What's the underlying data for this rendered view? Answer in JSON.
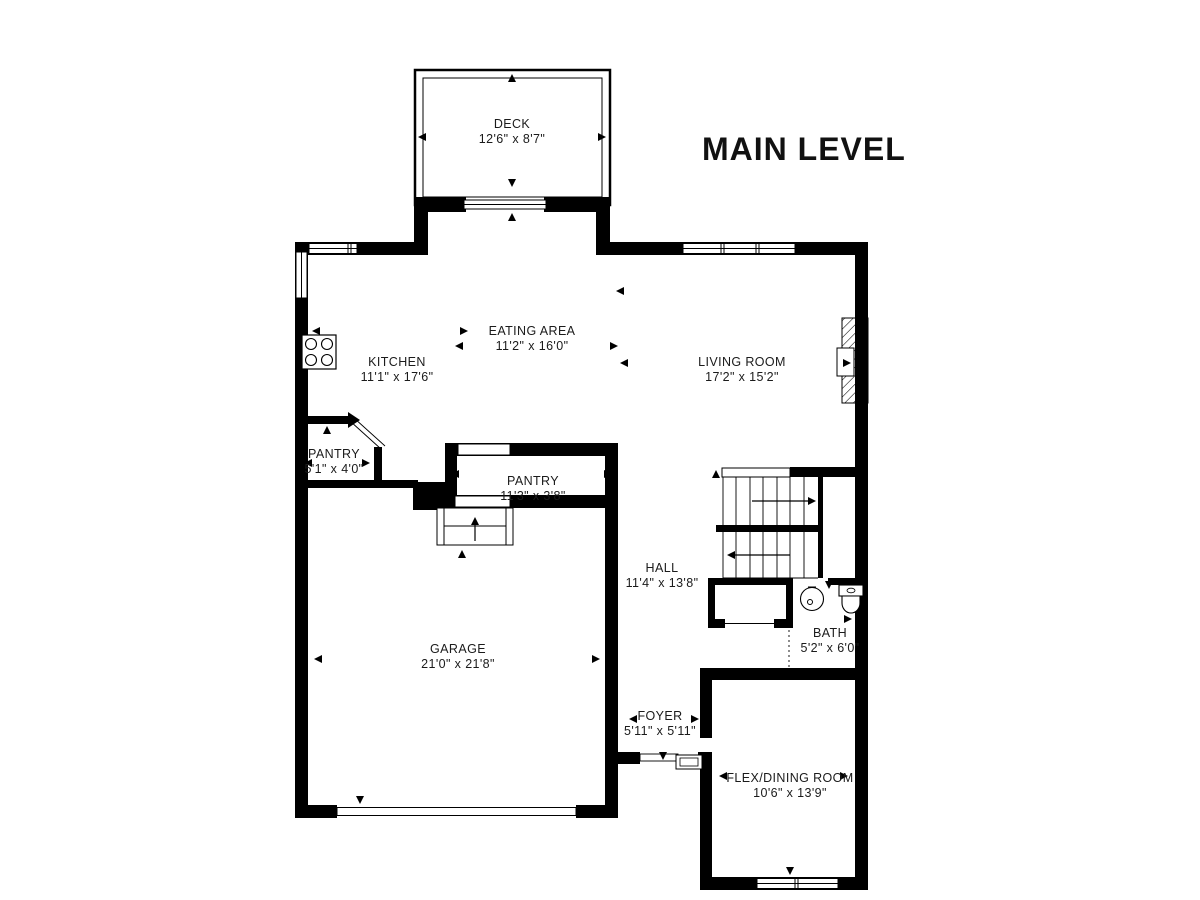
{
  "title": "MAIN LEVEL",
  "rooms": [
    {
      "name": "DECK",
      "dims": "12'6\" x 8'7\""
    },
    {
      "name": "EATING AREA",
      "dims": "11'2\" x 16'0\""
    },
    {
      "name": "KITCHEN",
      "dims": "11'1\" x 17'6\""
    },
    {
      "name": "LIVING ROOM",
      "dims": "17'2\" x 15'2\""
    },
    {
      "name": "PANTRY",
      "dims": "5'1\" x 4'0\""
    },
    {
      "name": "PANTRY",
      "dims": "11'3\" x 3'8\""
    },
    {
      "name": "GARAGE",
      "dims": "21'0\" x 21'8\""
    },
    {
      "name": "HALL",
      "dims": "11'4\" x 13'8\""
    },
    {
      "name": "BATH",
      "dims": "5'2\" x 6'0\""
    },
    {
      "name": "FOYER",
      "dims": "5'11\" x 5'11\""
    },
    {
      "name": "FLEX/DINING ROOM",
      "dims": "10'6\" x 13'9\""
    }
  ],
  "colors": {
    "wall": "#000000",
    "label": "#1b1b1b",
    "background": "#ffffff"
  },
  "icons": {
    "stove": "stove-icon",
    "sink": "sink-icon",
    "toilet": "toilet-icon",
    "fireplace": "fireplace-icon",
    "staircase": "staircase-icon",
    "garage_steps": "garage-steps-icon",
    "entry_step": "entry-step-icon"
  }
}
